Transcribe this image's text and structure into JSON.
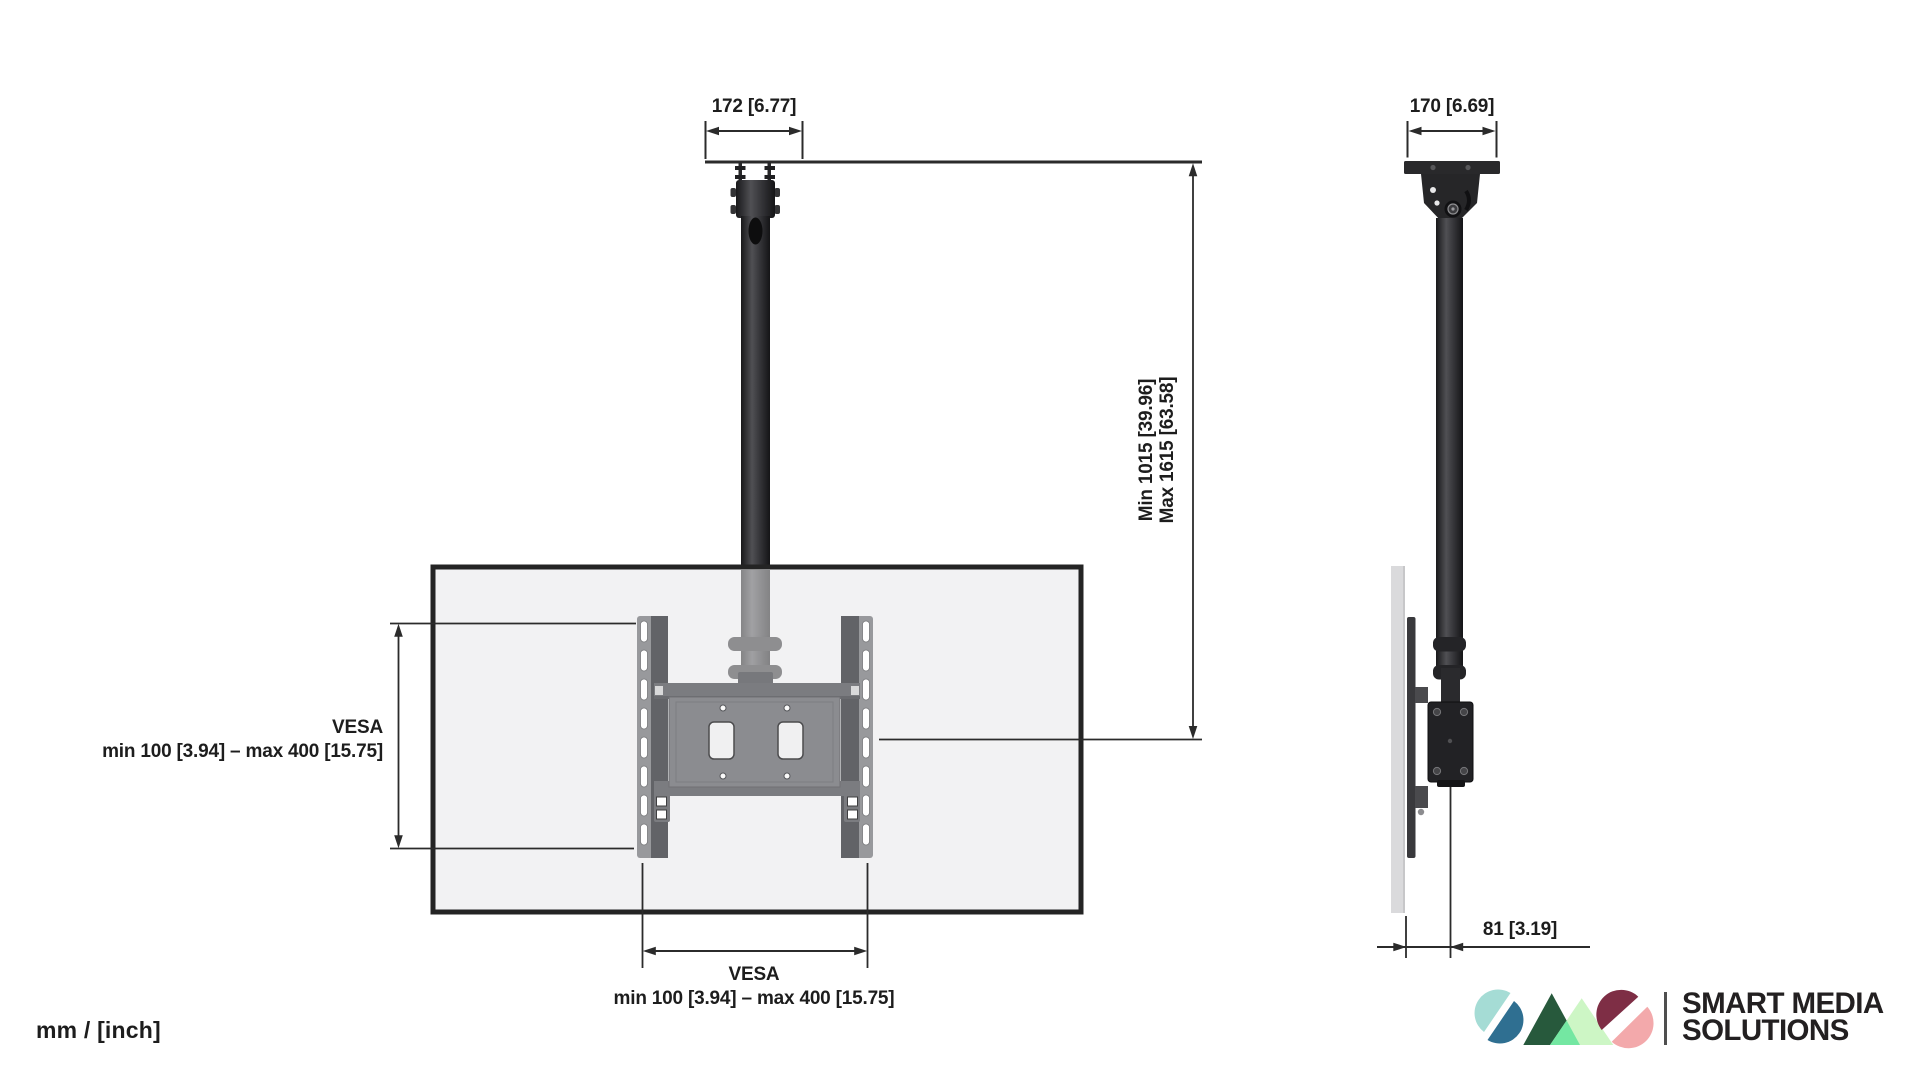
{
  "page": {
    "units_label": "mm / [inch]"
  },
  "front_view": {
    "dim_top_width": "172 [6.77]",
    "dim_height_line1": "Min 1015 [39.96]",
    "dim_height_line2": "Max 1615 [63.58]",
    "vesa_side_title": "VESA",
    "vesa_side_range": "min 100 [3.94] – max 400 [15.75]",
    "vesa_bottom_title": "VESA",
    "vesa_bottom_range": "min 100 [3.94] – max 400 [15.75]"
  },
  "side_view": {
    "dim_top_width": "170 [6.69]",
    "dim_depth": "81 [3.19]"
  },
  "logo": {
    "line1": "SMART MEDIA",
    "line2": "SOLUTIONS",
    "colors": {
      "teal_light": "#a5dcd5",
      "teal_dark": "#2f6f91",
      "green_dark": "#27593c",
      "green_light": "#cdf6c5",
      "green_mid": "#74e7a2",
      "burgundy": "#7e2e45",
      "pink": "#f3a9ab",
      "divider_gray": "#4f4f4f",
      "text_black": "#232021"
    }
  },
  "drawing_colors": {
    "line": "#2b2b2b",
    "text": "#1d1d1d",
    "metal_dark": "#222224",
    "metal_gray": "#8b8c90",
    "screen_fill": "#f2f2f3",
    "screen_border": "#242424"
  }
}
